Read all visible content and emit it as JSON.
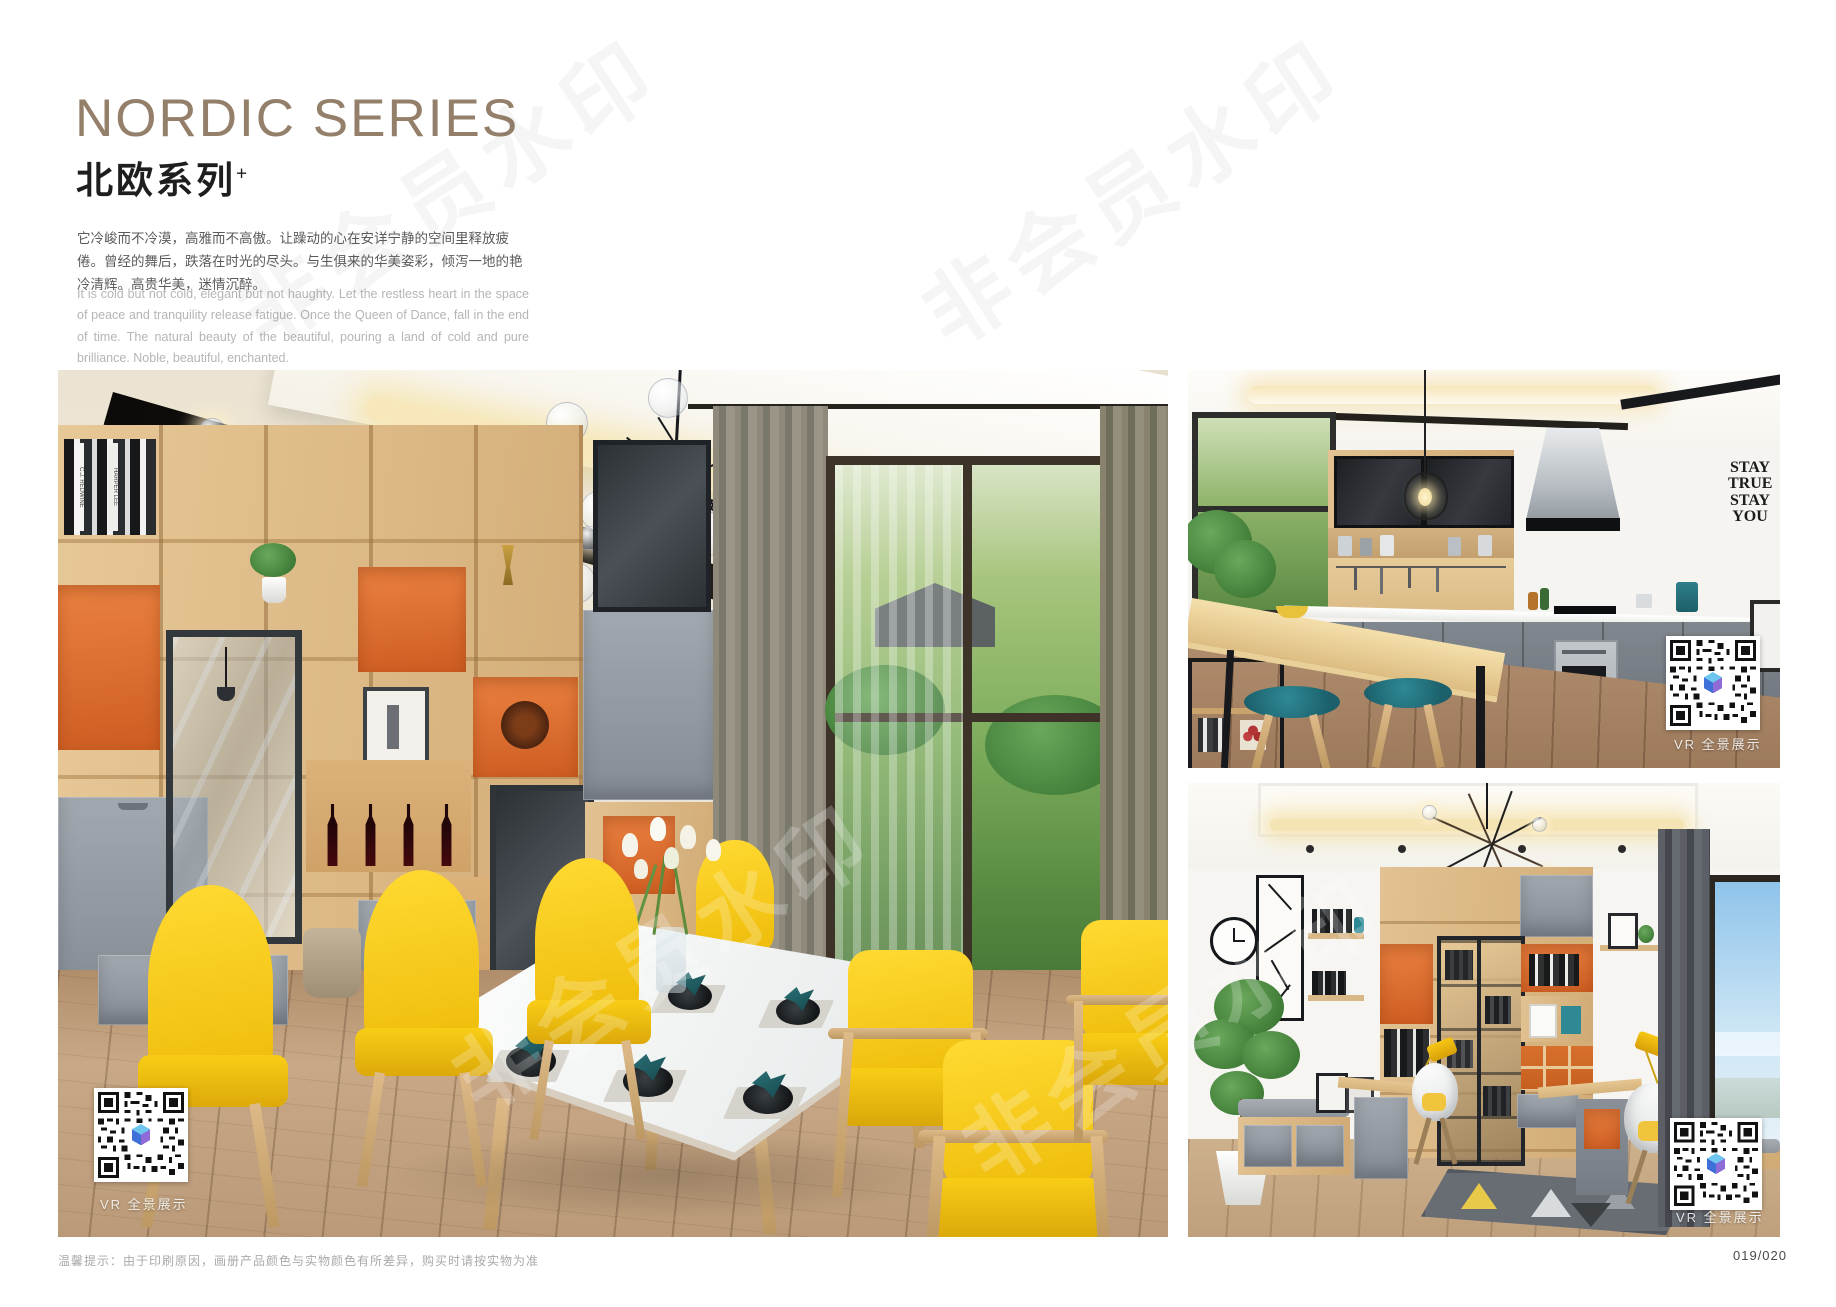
{
  "header": {
    "title": "NORDIC SERIES",
    "subtitle": "北欧系列",
    "subtitle_superscript": "+",
    "intro_cn": "它冷峻而不冷漠，高雅而不高傲。让躁动的心在安详宁静的空间里释放疲倦。曾经的舞后，跌落在时光的尽头。与生俱来的华美姿彩，倾泻一地的艳冷清辉。高贵华美，迷情沉醉。",
    "intro_en": "It is cold but not cold, elegant but not haughty. Let the restless heart in the space of peace and tranquility release fatigue. Once the Queen of Dance, fall in the end of time. The natural beauty of the beautiful, pouring a land of cold and pure brilliance. Noble, beautiful, enchanted."
  },
  "watermark": {
    "text": "非会员水印"
  },
  "photos": {
    "dining": {
      "vr_label": "VR 全景展示",
      "book_spine_1": "C.J. REDWINE",
      "book_spine_2": "HARPER LEE"
    },
    "kitchen": {
      "vr_label": "VR 全景展示",
      "wall_quote": [
        "STAY",
        "TRUE",
        "STAY",
        "YOU"
      ]
    },
    "study": {
      "vr_label": "VR 全景展示"
    }
  },
  "footer": {
    "notice": "温馨提示：由于印刷原因，画册产品颜色与实物颜色有所差异，购买时请按实物为准",
    "page_number": "019/020"
  },
  "colors": {
    "title_gold": "#94806a",
    "accent_orange": "#dd6e2a",
    "wood": "#dcba8c",
    "chair_yellow": "#f6ce17",
    "stool_teal": "#20737f",
    "napkin_teal": "#1e5a5e"
  }
}
